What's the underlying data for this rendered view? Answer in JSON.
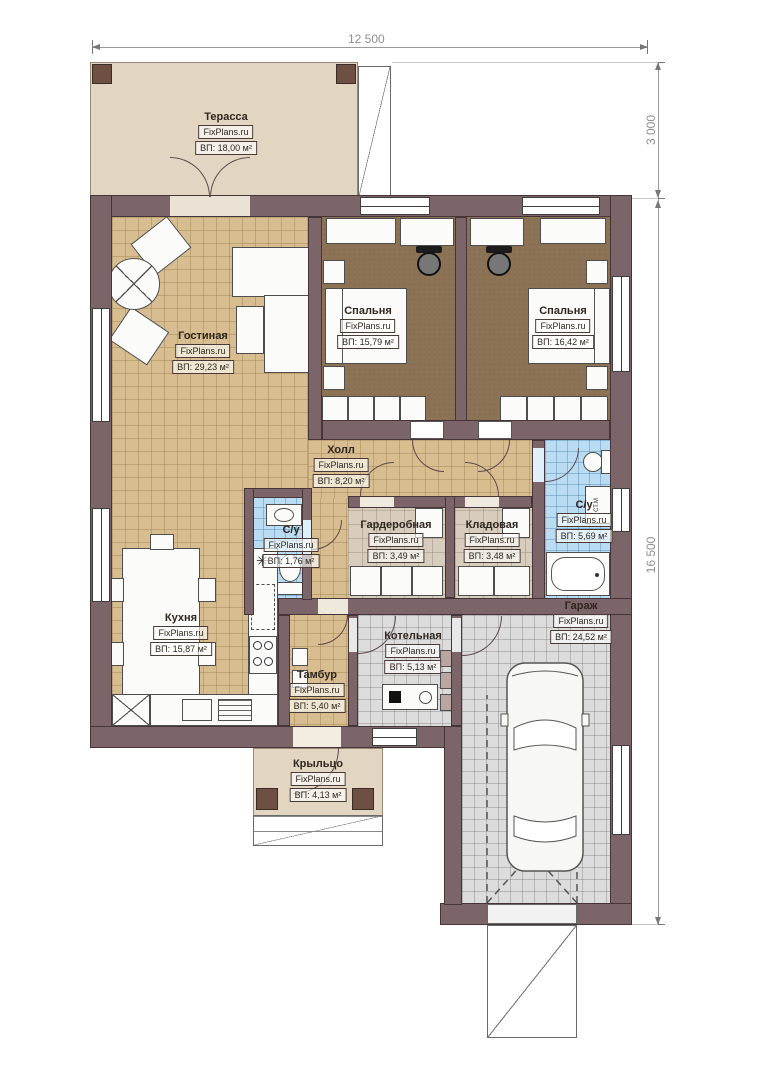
{
  "meta": {
    "brand": "FixPlans.ru"
  },
  "dimensions": {
    "top": "12 500",
    "right_top": "3 000",
    "right_main": "16 500"
  },
  "rooms": [
    {
      "name": "Терасса",
      "area": "ВП: 18,00 м²"
    },
    {
      "name": "Гостиная",
      "area": "ВП: 29,23 м²"
    },
    {
      "name": "Спальня",
      "area": "ВП: 15,79 м²"
    },
    {
      "name": "Спальня",
      "area": "ВП: 16,42 м²"
    },
    {
      "name": "Холл",
      "area": "ВП: 8,20 м²"
    },
    {
      "name": "Гардеробная",
      "area": "ВП: 3,49 м²"
    },
    {
      "name": "Кладовая",
      "area": "ВП: 3,48 м²"
    },
    {
      "name": "С/у",
      "area": "ВП: 5,69 м²"
    },
    {
      "name": "С/у",
      "area": "ВП: 1,76 м²"
    },
    {
      "name": "Кухня",
      "area": "ВП: 15,87 м²"
    },
    {
      "name": "Тамбур",
      "area": "ВП: 5,40 м²"
    },
    {
      "name": "Котельная",
      "area": "ВП: 5,13 м²"
    },
    {
      "name": "Гараж",
      "area": "ВП: 24,52 м²"
    },
    {
      "name": "Крыльцо",
      "area": "ВП: 4,13 м²"
    }
  ],
  "labels": {
    "washing_machine": "СТ.М",
    "sink_symbol": "✳"
  },
  "colors": {
    "wall": "#7b6568",
    "floor_wood": "#d7bd8f",
    "floor_bedroom": "#8d7356",
    "floor_tile_blue": "#b9dcf2",
    "floor_tile_grey": "#dcdcdc",
    "terrace": "#e2d6c2"
  }
}
